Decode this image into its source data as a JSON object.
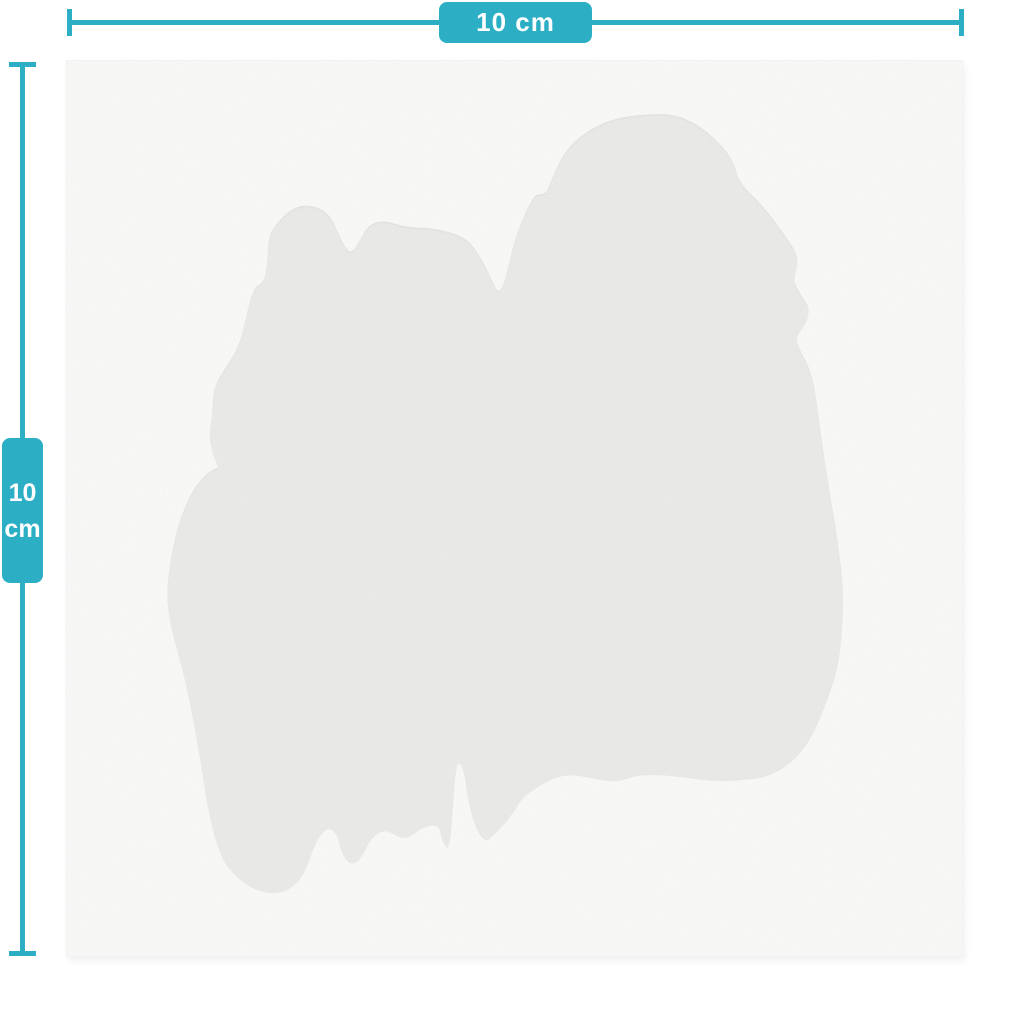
{
  "diagram": {
    "kind": "product-size-diagram",
    "width_dimension": {
      "label": "10 cm",
      "value": "10",
      "unit": "cm"
    },
    "height_dimension": {
      "value": "10",
      "unit": "cm"
    }
  },
  "colors": {
    "page": "#ffffff",
    "accent": "#2cafc5",
    "label_text": "#ffffff",
    "canvas": "#fbfbfa",
    "blob": "#ececea",
    "blob_rim": "#e3e3e0"
  }
}
